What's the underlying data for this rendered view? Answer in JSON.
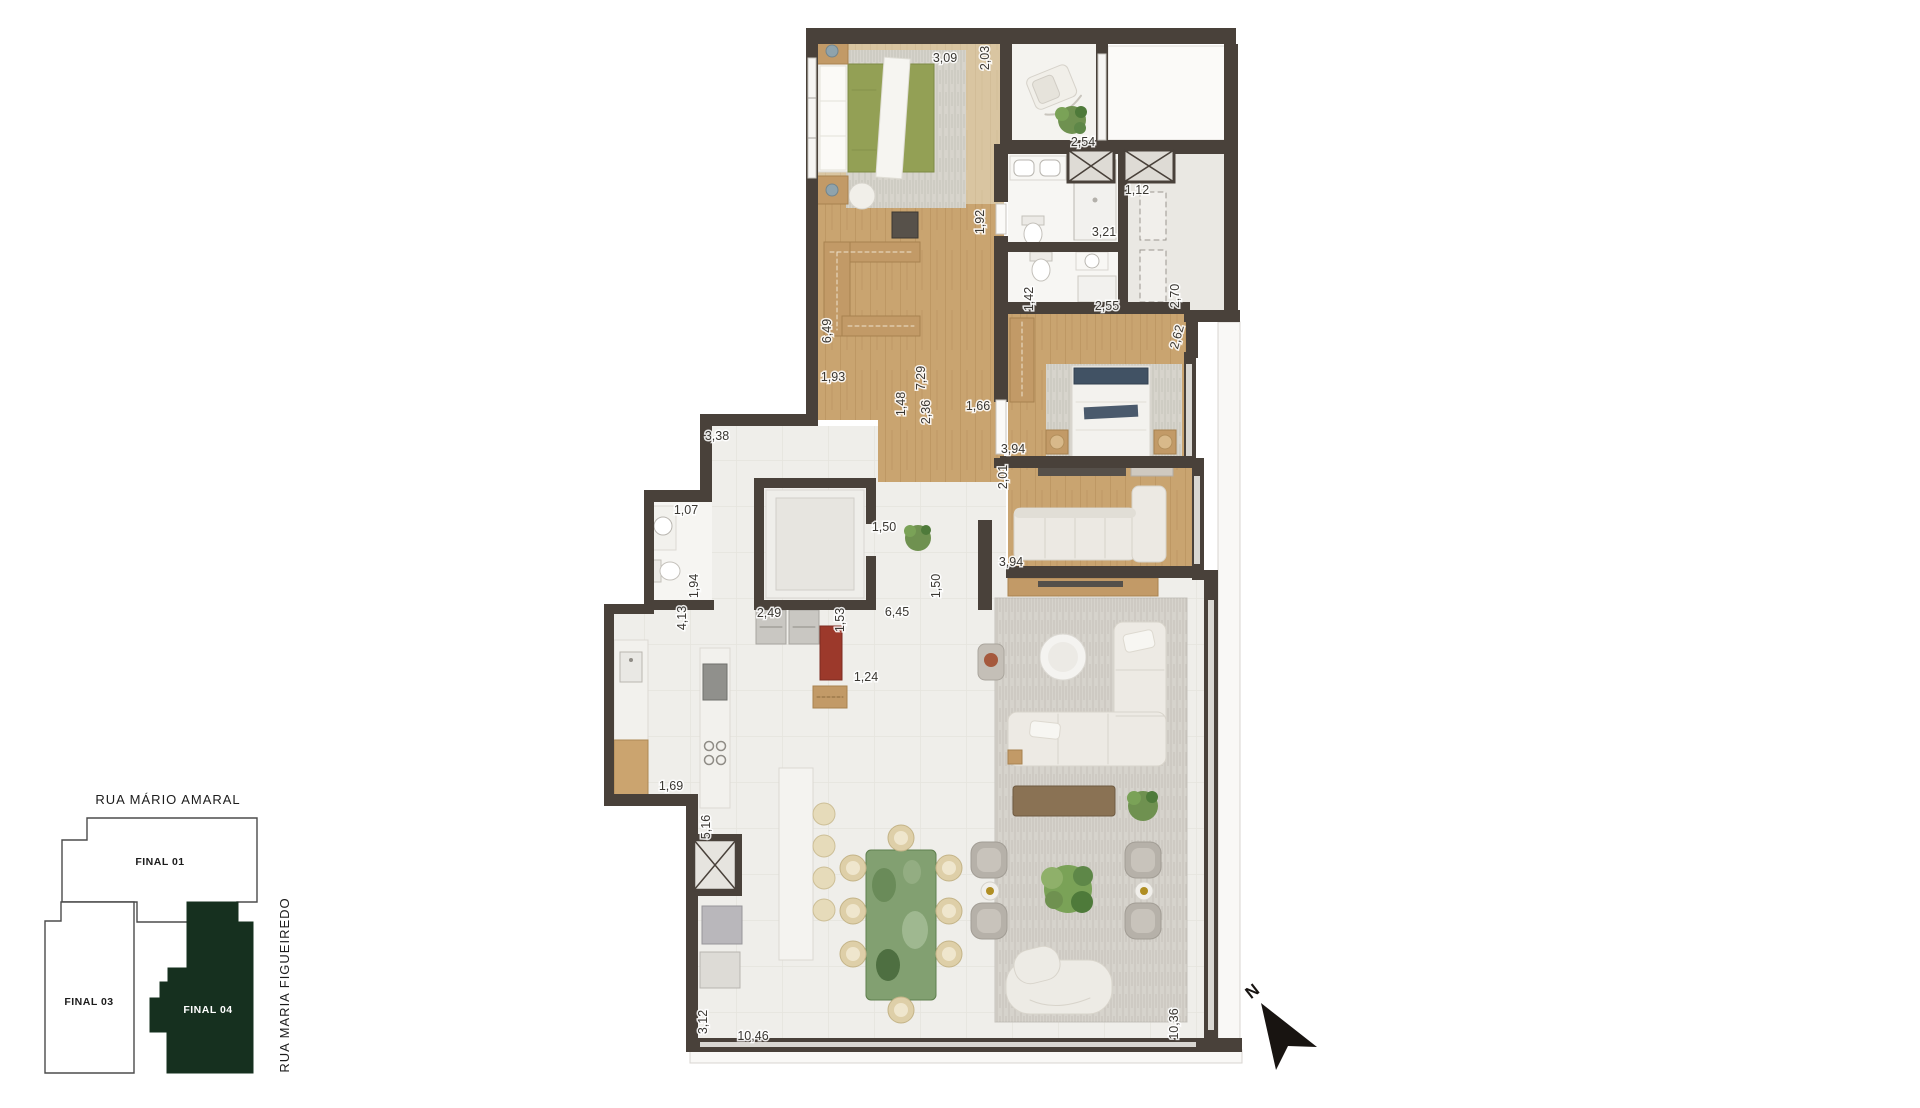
{
  "plan": {
    "dimensions": [
      {
        "text": "3,09",
        "x": 945,
        "y": 58,
        "rot": 0
      },
      {
        "text": "2,03",
        "x": 985,
        "y": 58,
        "rot": -90
      },
      {
        "text": "2,54",
        "x": 1083,
        "y": 142,
        "rot": 0
      },
      {
        "text": "1,92",
        "x": 980,
        "y": 222,
        "rot": -90
      },
      {
        "text": "3,21",
        "x": 1104,
        "y": 232,
        "rot": 0
      },
      {
        "text": "1,12",
        "x": 1137,
        "y": 190,
        "rot": 0
      },
      {
        "text": "1,42",
        "x": 1029,
        "y": 299,
        "rot": -90
      },
      {
        "text": "2,55",
        "x": 1107,
        "y": 306,
        "rot": 0
      },
      {
        "text": "2,70",
        "x": 1175,
        "y": 296,
        "rot": -90
      },
      {
        "text": "2,62",
        "x": 1177,
        "y": 337,
        "rot": -75
      },
      {
        "text": "6,49",
        "x": 827,
        "y": 331,
        "rot": -90
      },
      {
        "text": "1,93",
        "x": 833,
        "y": 377,
        "rot": 0
      },
      {
        "text": "7,29",
        "x": 921,
        "y": 378,
        "rot": -90
      },
      {
        "text": "1,48",
        "x": 901,
        "y": 404,
        "rot": -90
      },
      {
        "text": "2,36",
        "x": 926,
        "y": 412,
        "rot": -90
      },
      {
        "text": "1,66",
        "x": 978,
        "y": 406,
        "rot": 0
      },
      {
        "text": "3,38",
        "x": 717,
        "y": 436,
        "rot": 0
      },
      {
        "text": "1,07",
        "x": 686,
        "y": 510,
        "rot": 0
      },
      {
        "text": "1,94",
        "x": 694,
        "y": 586,
        "rot": -90
      },
      {
        "text": "4,13",
        "x": 682,
        "y": 618,
        "rot": -90
      },
      {
        "text": "2,49",
        "x": 769,
        "y": 613,
        "rot": 0
      },
      {
        "text": "1,50",
        "x": 884,
        "y": 527,
        "rot": 0
      },
      {
        "text": "1,50",
        "x": 936,
        "y": 586,
        "rot": -90
      },
      {
        "text": "6,45",
        "x": 897,
        "y": 612,
        "rot": 0
      },
      {
        "text": "1,53",
        "x": 840,
        "y": 620,
        "rot": -90
      },
      {
        "text": "1,24",
        "x": 866,
        "y": 677,
        "rot": 0
      },
      {
        "text": "1,69",
        "x": 671,
        "y": 786,
        "rot": 0
      },
      {
        "text": "5,16",
        "x": 706,
        "y": 827,
        "rot": -90
      },
      {
        "text": "3,12",
        "x": 703,
        "y": 1022,
        "rot": -90
      },
      {
        "text": "10,46",
        "x": 753,
        "y": 1036,
        "rot": 0
      },
      {
        "text": "10,36",
        "x": 1174,
        "y": 1024,
        "rot": -90
      },
      {
        "text": "3,94",
        "x": 1013,
        "y": 449,
        "rot": 0
      },
      {
        "text": "2,01",
        "x": 1003,
        "y": 477,
        "rot": -90
      },
      {
        "text": "3,94",
        "x": 1011,
        "y": 562,
        "rot": 0
      }
    ]
  },
  "keyplan": {
    "street_top": "RUA MÁRIO AMARAL",
    "street_right": "RUA MARIA FIGUEIREDO",
    "units": [
      {
        "label": "FINAL 01",
        "highlighted": false
      },
      {
        "label": "FINAL 03",
        "highlighted": false
      },
      {
        "label": "FINAL 04",
        "highlighted": true
      }
    ],
    "highlight_color": "#16301f"
  },
  "compass": {
    "label": "N"
  },
  "colors": {
    "wall": "#49413a",
    "wood_floor": "#c9a470",
    "wood_light": "#d9c5a1",
    "tile": "#efeeea",
    "rug": "#d6d3cc",
    "duvet_green": "#93a055",
    "navy_accent": "#415264",
    "marble_table_green": "#7e9b6d",
    "keyplan_highlight": "#16301f",
    "compass": "#181411"
  }
}
